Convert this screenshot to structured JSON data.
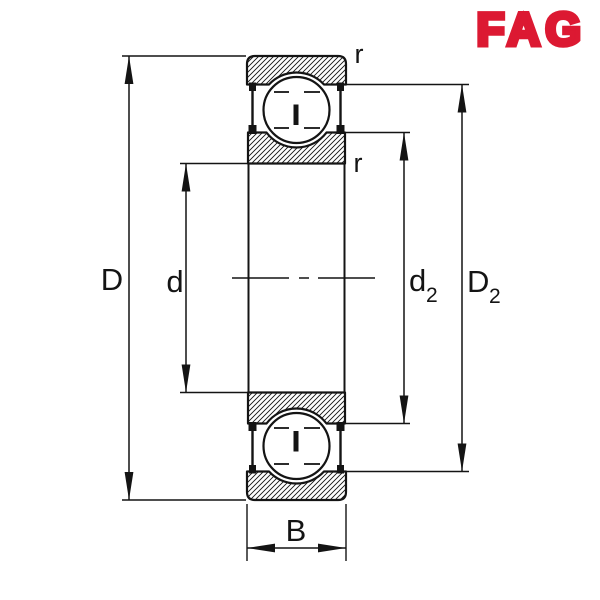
{
  "page": {
    "background": "#ffffff",
    "line_color": "#141414"
  },
  "brand": {
    "name": "FAG",
    "color": "#dc1932"
  },
  "drawing": {
    "type": "deep-groove-ball-bearing-cross-section-with-shields",
    "dimension_labels": {
      "D": "D",
      "d": "d",
      "d2_base": "d",
      "d2_sub": "2",
      "D2_base": "D",
      "D2_sub": "2",
      "B": "B",
      "r_top": "r",
      "r_bottom": "r"
    }
  }
}
